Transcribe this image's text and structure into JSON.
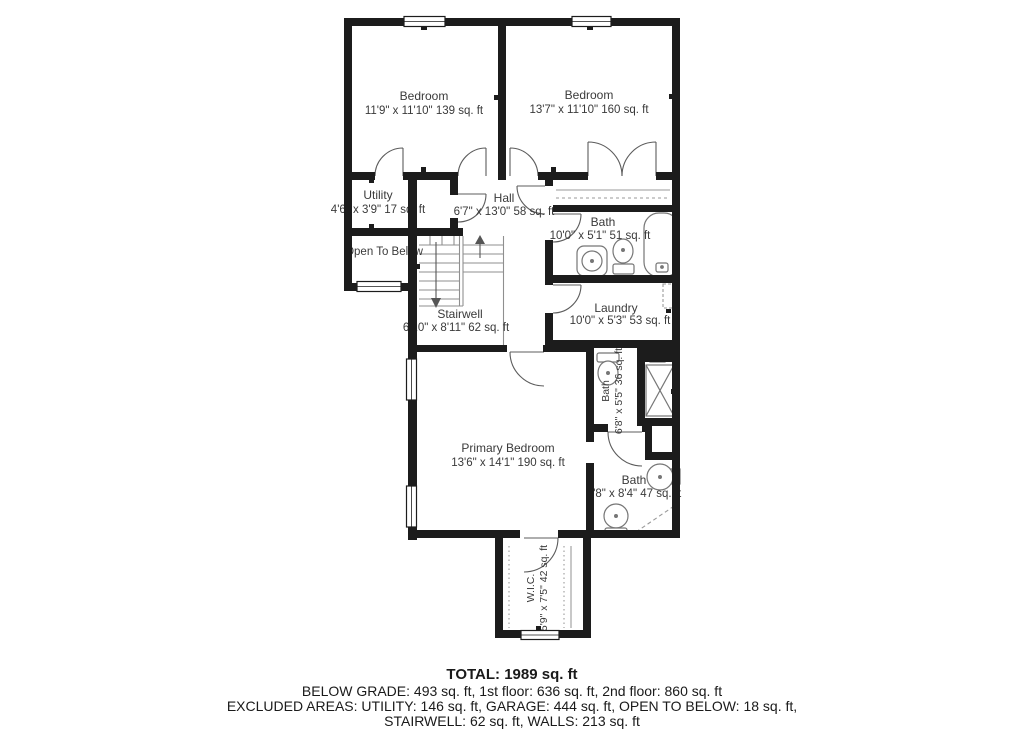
{
  "floor_plan": {
    "rooms": {
      "bedroom_1": {
        "name": "Bedroom",
        "dims": "11'9\" x 11'10\" 139 sq. ft"
      },
      "bedroom_2": {
        "name": "Bedroom",
        "dims": "13'7\" x 11'10\" 160 sq. ft"
      },
      "utility": {
        "name": "Utility",
        "dims": "4'6\" x 3'9\" 17 sq. ft"
      },
      "hall": {
        "name": "Hall",
        "dims": "6'7\" x 13'0\" 58 sq. ft"
      },
      "bath_upper": {
        "name": "Bath",
        "dims": "10'0\" x 5'1\" 51 sq. ft"
      },
      "open_to_below": {
        "name": "Open To Below"
      },
      "stairwell": {
        "name": "Stairwell",
        "dims": "6'10\" x 8'11\" 62 sq. ft"
      },
      "laundry": {
        "name": "Laundry",
        "dims": "10'0\" x 5'3\" 53 sq. ft"
      },
      "primary_bedroom": {
        "name": "Primary Bedroom",
        "dims": "13'6\" x 14'1\" 190 sq. ft"
      },
      "bath_ensuite_small": {
        "name": "Bath",
        "dims": "6'8\" x 5'5\" 36 sq. ft"
      },
      "bath_ensuite": {
        "name": "Bath",
        "dims": "6'8\" x 8'4\" 47 sq. ft"
      },
      "wic": {
        "name": "W.I.C.",
        "dims": "5'9\" x 7'5\" 42 sq. ft"
      }
    },
    "summary": {
      "total": "TOTAL: 1989 sq. ft",
      "line2": "BELOW GRADE: 493 sq. ft, 1st floor: 636 sq. ft, 2nd floor: 860 sq. ft",
      "line3": "EXCLUDED AREAS: UTILITY: 146 sq. ft, GARAGE: 444 sq. ft, OPEN TO BELOW: 18 sq. ft,",
      "line4": "STAIRWELL: 62 sq. ft, WALLS: 213 sq. ft"
    },
    "colors": {
      "wall": "#1c1c1c",
      "fixture_line": "#777777",
      "text": "#3a3a3a"
    }
  }
}
